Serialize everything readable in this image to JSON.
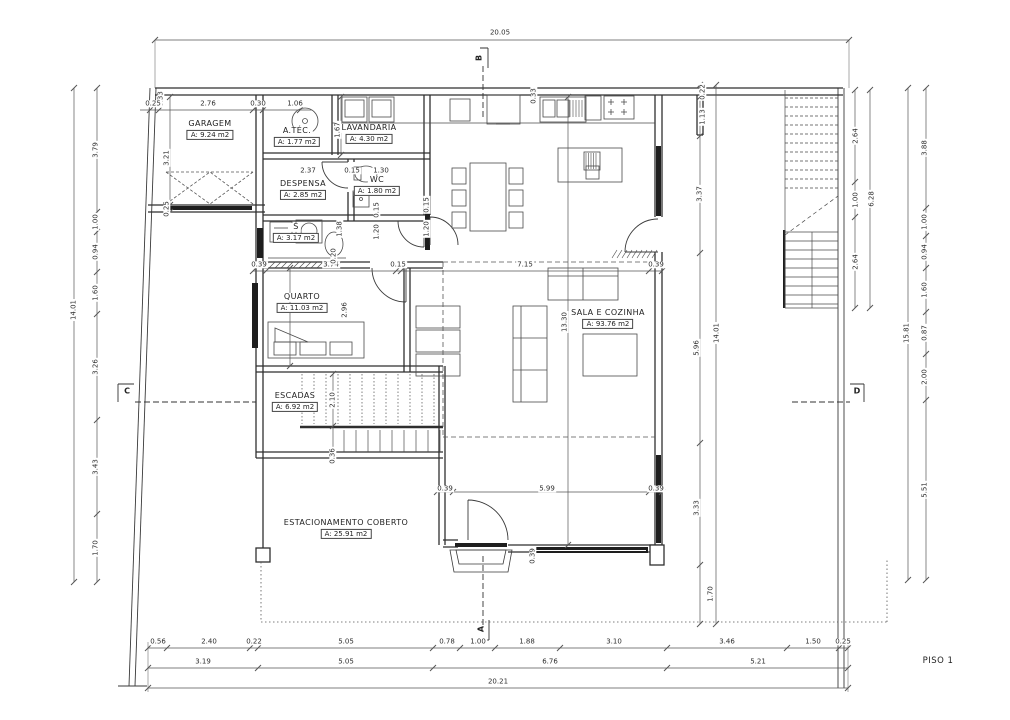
{
  "floor_label": "PISO 1",
  "colors": {
    "wall": "#2f2f2f",
    "dim_line": "#555555",
    "text": "#2e2e2e",
    "background": "#ffffff"
  },
  "markers": [
    {
      "label": "A"
    },
    {
      "label": "B"
    },
    {
      "label": "C"
    },
    {
      "label": "D"
    }
  ],
  "rooms": [
    {
      "name": "GARAGEM",
      "area": "A: 9.24 m2",
      "x": 210,
      "y": 130
    },
    {
      "name": "A.TÉC.",
      "area": "A: 1.77 m2",
      "x": 297,
      "y": 137
    },
    {
      "name": "LAVANDARIA",
      "area": "A: 4.30 m2",
      "x": 369,
      "y": 134
    },
    {
      "name": "DESPENSA",
      "area": "A: 2.85 m2",
      "x": 303,
      "y": 190
    },
    {
      "name": "WC",
      "area": "A: 1.80 m2",
      "x": 377,
      "y": 186
    },
    {
      "name": "S",
      "area": "A: 3.17 m2",
      "x": 296,
      "y": 233
    },
    {
      "name": "QUARTO",
      "area": "A: 11.03 m2",
      "x": 302,
      "y": 303
    },
    {
      "name": "ESCADAS",
      "area": "A: 6.92 m2",
      "x": 295,
      "y": 402
    },
    {
      "name": "SALA E COZINHA",
      "area": "A: 93.76 m2",
      "x": 608,
      "y": 319
    },
    {
      "name": "ESTACIONAMENTO COBERTO",
      "area": "A: 25.91 m2",
      "x": 346,
      "y": 529
    }
  ],
  "dimensions": [
    {
      "v": "20.05",
      "x": 500,
      "y": 33,
      "o": "h"
    },
    {
      "v": "0.33",
      "x": 161,
      "y": 99,
      "o": "v"
    },
    {
      "v": "0.25",
      "x": 153,
      "y": 104,
      "o": "h"
    },
    {
      "v": "2.76",
      "x": 208,
      "y": 104,
      "o": "h"
    },
    {
      "v": "0.30",
      "x": 258,
      "y": 104,
      "o": "h"
    },
    {
      "v": "1.06",
      "x": 295,
      "y": 104,
      "o": "h"
    },
    {
      "v": "0.33",
      "x": 534,
      "y": 96,
      "o": "v"
    },
    {
      "v": "0.22",
      "x": 703,
      "y": 92,
      "o": "v"
    },
    {
      "v": "1.13",
      "x": 703,
      "y": 117,
      "o": "v"
    },
    {
      "v": "3.37",
      "x": 700,
      "y": 194,
      "o": "v"
    },
    {
      "v": "5.96",
      "x": 697,
      "y": 348,
      "o": "v"
    },
    {
      "v": "3.33",
      "x": 697,
      "y": 508,
      "o": "v"
    },
    {
      "v": "1.70",
      "x": 711,
      "y": 594,
      "o": "v"
    },
    {
      "v": "14.01",
      "x": 717,
      "y": 333,
      "o": "v"
    },
    {
      "v": "14.01",
      "x": 74,
      "y": 310,
      "o": "v"
    },
    {
      "v": "3.79",
      "x": 96,
      "y": 150,
      "o": "v"
    },
    {
      "v": "1.00",
      "x": 96,
      "y": 222,
      "o": "v"
    },
    {
      "v": "0.94",
      "x": 96,
      "y": 252,
      "o": "v"
    },
    {
      "v": "1.60",
      "x": 96,
      "y": 293,
      "o": "v"
    },
    {
      "v": "3.26",
      "x": 96,
      "y": 367,
      "o": "v"
    },
    {
      "v": "3.43",
      "x": 96,
      "y": 467,
      "o": "v"
    },
    {
      "v": "1.70",
      "x": 96,
      "y": 548,
      "o": "v"
    },
    {
      "v": "15.81",
      "x": 907,
      "y": 333,
      "o": "v"
    },
    {
      "v": "3.88",
      "x": 925,
      "y": 148,
      "o": "v"
    },
    {
      "v": "1.00",
      "x": 925,
      "y": 222,
      "o": "v"
    },
    {
      "v": "0.94",
      "x": 925,
      "y": 252,
      "o": "v"
    },
    {
      "v": "1.60",
      "x": 925,
      "y": 290,
      "o": "v"
    },
    {
      "v": "0.87",
      "x": 925,
      "y": 333,
      "o": "v"
    },
    {
      "v": "2.00",
      "x": 925,
      "y": 377,
      "o": "v"
    },
    {
      "v": "5.51",
      "x": 925,
      "y": 490,
      "o": "v"
    },
    {
      "v": "2.64",
      "x": 856,
      "y": 136,
      "o": "v"
    },
    {
      "v": "1.00",
      "x": 856,
      "y": 200,
      "o": "v"
    },
    {
      "v": "2.64",
      "x": 856,
      "y": 262,
      "o": "v"
    },
    {
      "v": "6.28",
      "x": 872,
      "y": 199,
      "o": "v"
    },
    {
      "v": "0.39",
      "x": 259,
      "y": 265,
      "o": "h"
    },
    {
      "v": "3.74",
      "x": 331,
      "y": 265,
      "o": "h"
    },
    {
      "v": "0.15",
      "x": 398,
      "y": 265,
      "o": "h"
    },
    {
      "v": "7.15",
      "x": 525,
      "y": 265,
      "o": "h"
    },
    {
      "v": "0.39",
      "x": 656,
      "y": 265,
      "o": "h"
    },
    {
      "v": "0.39",
      "x": 445,
      "y": 489,
      "o": "h"
    },
    {
      "v": "5.99",
      "x": 547,
      "y": 489,
      "o": "h"
    },
    {
      "v": "0.39",
      "x": 656,
      "y": 489,
      "o": "h"
    },
    {
      "v": "0.56",
      "x": 158,
      "y": 642,
      "o": "h"
    },
    {
      "v": "2.40",
      "x": 209,
      "y": 642,
      "o": "h"
    },
    {
      "v": "0.22",
      "x": 254,
      "y": 642,
      "o": "h"
    },
    {
      "v": "5.05",
      "x": 346,
      "y": 642,
      "o": "h"
    },
    {
      "v": "0.78",
      "x": 447,
      "y": 642,
      "o": "h"
    },
    {
      "v": "1.00",
      "x": 478,
      "y": 642,
      "o": "h"
    },
    {
      "v": "1.88",
      "x": 527,
      "y": 642,
      "o": "h"
    },
    {
      "v": "3.10",
      "x": 614,
      "y": 642,
      "o": "h"
    },
    {
      "v": "3.46",
      "x": 727,
      "y": 642,
      "o": "h"
    },
    {
      "v": "1.50",
      "x": 813,
      "y": 642,
      "o": "h"
    },
    {
      "v": "0.25",
      "x": 843,
      "y": 642,
      "o": "h"
    },
    {
      "v": "3.19",
      "x": 203,
      "y": 662,
      "o": "h"
    },
    {
      "v": "5.05",
      "x": 346,
      "y": 662,
      "o": "h"
    },
    {
      "v": "6.76",
      "x": 550,
      "y": 662,
      "o": "h"
    },
    {
      "v": "5.21",
      "x": 758,
      "y": 662,
      "o": "h"
    },
    {
      "v": "20.21",
      "x": 498,
      "y": 682,
      "o": "h"
    },
    {
      "v": "3.21",
      "x": 167,
      "y": 158,
      "o": "v"
    },
    {
      "v": "0.25",
      "x": 167,
      "y": 209,
      "o": "v"
    },
    {
      "v": "1.67",
      "x": 338,
      "y": 130,
      "o": "v"
    },
    {
      "v": "2.37",
      "x": 308,
      "y": 171,
      "o": "h"
    },
    {
      "v": "0.15",
      "x": 352,
      "y": 171,
      "o": "h"
    },
    {
      "v": "1.30",
      "x": 381,
      "y": 171,
      "o": "h"
    },
    {
      "v": "0.15",
      "x": 377,
      "y": 210,
      "o": "v"
    },
    {
      "v": "1.20",
      "x": 377,
      "y": 232,
      "o": "v"
    },
    {
      "v": "0.15",
      "x": 427,
      "y": 205,
      "o": "v"
    },
    {
      "v": "1.20",
      "x": 427,
      "y": 229,
      "o": "v"
    },
    {
      "v": "1.38",
      "x": 340,
      "y": 229,
      "o": "v"
    },
    {
      "v": "0.20",
      "x": 334,
      "y": 256,
      "o": "v"
    },
    {
      "v": "2.96",
      "x": 345,
      "y": 310,
      "o": "v"
    },
    {
      "v": "13.30",
      "x": 565,
      "y": 322,
      "o": "v"
    },
    {
      "v": "2.10",
      "x": 333,
      "y": 400,
      "o": "v"
    },
    {
      "v": "0.36",
      "x": 333,
      "y": 456,
      "o": "v"
    },
    {
      "v": "0.39",
      "x": 533,
      "y": 556,
      "o": "v"
    }
  ]
}
